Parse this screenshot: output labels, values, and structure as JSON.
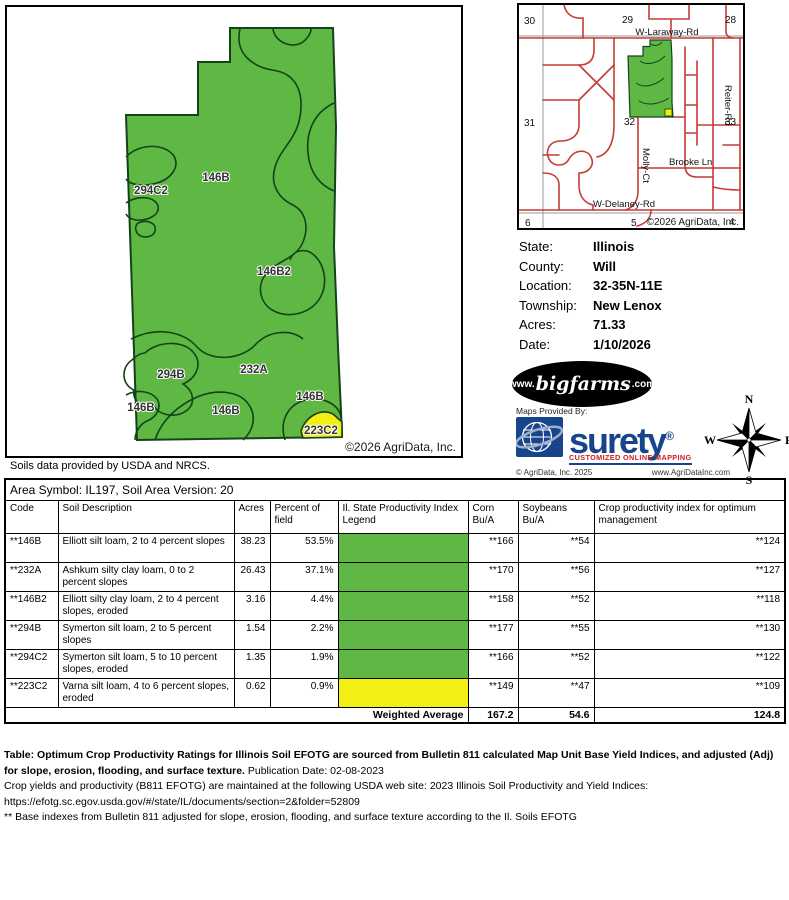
{
  "main_map": {
    "copyright": "©2026 AgriData, Inc.",
    "labels": [
      {
        "text": "294C2"
      },
      {
        "text": "146B"
      },
      {
        "text": "146B2"
      },
      {
        "text": "294B"
      },
      {
        "text": "232A"
      },
      {
        "text": "146B"
      },
      {
        "text": "146B"
      },
      {
        "text": "146B"
      },
      {
        "text": "223C2"
      }
    ]
  },
  "soils_note": "Soils data provided by USDA and NRCS.",
  "locator_map": {
    "copyright": "©2026 AgriData, Inc.",
    "sections": [
      "30",
      "29",
      "28",
      "31",
      "32",
      "33",
      "6",
      "5",
      "4"
    ],
    "roads": {
      "laraway": "W-Laraway-Rd",
      "reiter": "Reiter-Rd",
      "molly": "Molly-Ct",
      "brooke": "Brooke Ln",
      "delaney": "W-Delaney-Rd"
    }
  },
  "info_panel": {
    "rows": [
      {
        "label": "State:",
        "value": "Illinois"
      },
      {
        "label": "County:",
        "value": "Will"
      },
      {
        "label": "Location:",
        "value": "32-35N-11E"
      },
      {
        "label": "Township:",
        "value": "New Lenox"
      },
      {
        "label": "Acres:",
        "value": "71.33"
      },
      {
        "label": "Date:",
        "value": "1/10/2026"
      }
    ]
  },
  "logos": {
    "bigfarms_prefix": "www.",
    "bigfarms_name": "bigfarms",
    "bigfarms_suffix": ".com",
    "maps_provided_by": "Maps Provided By:",
    "surety_name": "surety",
    "surety_reg": "®",
    "surety_tagline": "CUSTOMIZED ONLINE MAPPING",
    "surety_copyright": "© AgriData, Inc. 2025",
    "surety_url": "www.AgriDataInc.com"
  },
  "compass": {
    "n": "N",
    "s": "S",
    "e": "E",
    "w": "W"
  },
  "soil_table": {
    "area_symbol_line": "Area Symbol: IL197, Soil Area Version: 20",
    "headers": [
      "Code",
      "Soil Description",
      "Acres",
      "Percent of field",
      "Il. State Productivity Index Legend",
      "Corn Bu/A",
      "Soybeans Bu/A",
      "Crop productivity index for optimum management"
    ],
    "rows": [
      {
        "code": "**146B",
        "desc": "Elliott silt loam, 2 to 4 percent slopes",
        "acres": "38.23",
        "pct": "53.5%",
        "corn": "**166",
        "soy": "**54",
        "crop": "**124"
      },
      {
        "code": "**232A",
        "desc": "Ashkum silty clay loam, 0 to 2 percent slopes",
        "acres": "26.43",
        "pct": "37.1%",
        "corn": "**170",
        "soy": "**56",
        "crop": "**127"
      },
      {
        "code": "**146B2",
        "desc": "Elliott silty clay loam, 2 to 4 percent slopes, eroded",
        "acres": "3.16",
        "pct": "4.4%",
        "corn": "**158",
        "soy": "**52",
        "crop": "**118"
      },
      {
        "code": "**294B",
        "desc": "Symerton silt loam, 2 to 5 percent slopes",
        "acres": "1.54",
        "pct": "2.2%",
        "corn": "**177",
        "soy": "**55",
        "crop": "**130"
      },
      {
        "code": "**294C2",
        "desc": "Symerton silt loam, 5 to 10 percent slopes, eroded",
        "acres": "1.35",
        "pct": "1.9%",
        "corn": "**166",
        "soy": "**52",
        "crop": "**122"
      },
      {
        "code": "**223C2",
        "desc": "Varna silt loam, 4 to 6 percent slopes, eroded",
        "acres": "0.62",
        "pct": "0.9%",
        "corn": "**149",
        "soy": "**47",
        "crop": "**109"
      }
    ],
    "weighted_average": {
      "label": "Weighted Average",
      "corn": "167.2",
      "soy": "54.6",
      "crop": "124.8"
    }
  },
  "footer": {
    "line1_bold": "Table: Optimum Crop Productivity Ratings for Illinois Soil EFOTG are sourced from Bulletin 811 calculated Map Unit Base Yield Indices, and adjusted (Adj) for slope, erosion, flooding, and surface texture.",
    "line1_normal": " Publication Date: 02-08-2023",
    "line2": "Crop yields and productivity (B811 EFOTG) are maintained at the following USDA web site: 2023 Illinois Soil Productivity and Yield Indices:",
    "line3": "https://efotg.sc.egov.usda.gov/#/state/IL/documents/section=2&folder=52809",
    "line4": "** Base indexes from Bulletin 811 adjusted for slope, erosion, flooding, and surface texture according to the Il. Soils EFOTG"
  },
  "colors": {
    "field_green": "#5eb843",
    "legend_yellow": "#f3ee14",
    "contour_dark": "#14431a",
    "road_red": "#c63b32",
    "section_gray": "#999999",
    "surety_blue": "#17458c",
    "surety_red": "#c42127"
  }
}
